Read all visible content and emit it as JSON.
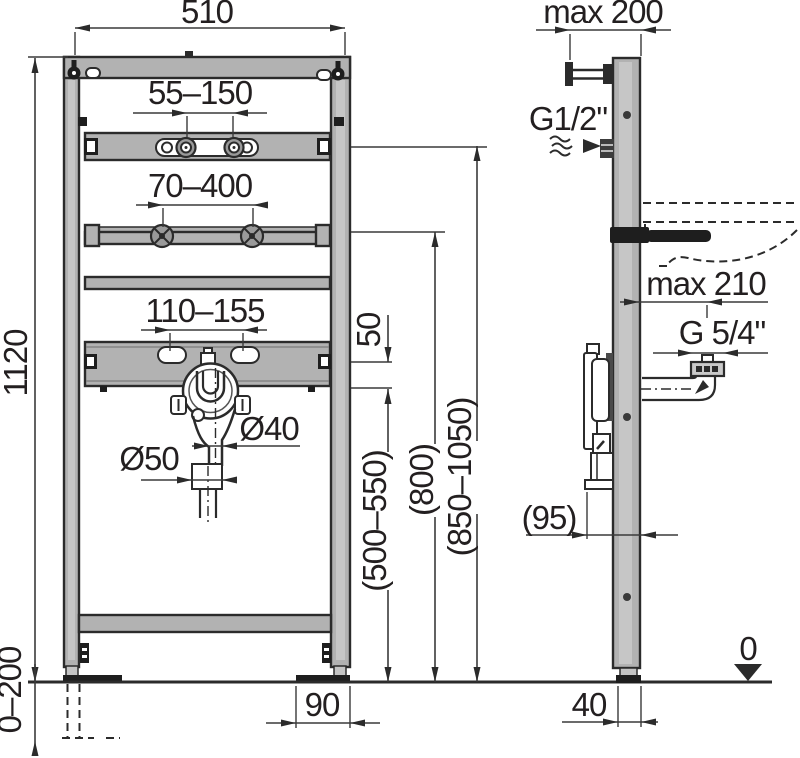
{
  "colors": {
    "frame_fill": "#b2b2b2",
    "frame_highlight": "#c6c6c6",
    "outline": "#2b2b2b",
    "dimension_line": "#3a3a3a",
    "text": "#231f20"
  },
  "front_view": {
    "width": "510",
    "height": "1120",
    "tap_spacing": "55–150",
    "crossbar_spacing": "70–400",
    "basin_bolt_spacing": "110–155",
    "offset": "50",
    "drain_pipe_diameter": "Ø40",
    "drain_socket_diameter": "Ø50",
    "drain_height": "(500–550)",
    "crossbar_height": "(800)",
    "tap_rail_height": "(850–1050)",
    "leg_extension": "0–200",
    "foot_length": "90"
  },
  "side_view": {
    "wall_offset": "max 200",
    "water_inlet": "G1/2\"",
    "basin_depth": "max 210",
    "drain_thread": "G 5/4\"",
    "bracket_depth": "(95)",
    "profile_depth": "40",
    "floor_level": "0"
  }
}
